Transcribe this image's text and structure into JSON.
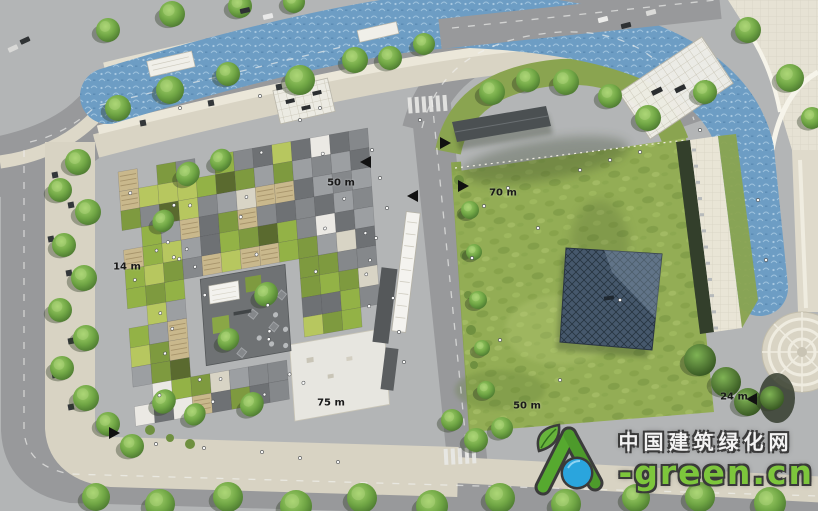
{
  "meta": {
    "title": "Landscape master plan rendering - checkerboard plaza and lawn pavilion site",
    "view": "aerial site plan"
  },
  "labels": {
    "plaza_top_width": "50 m",
    "plaza_module": "14 m",
    "plaza_length": "75 m",
    "lawn_top_width": "70 m",
    "lawn_bottom_width": "50 m",
    "lawn_side_depth": "24 m"
  },
  "icons": {
    "section_marker_left": "◀",
    "section_marker_right": "▶"
  },
  "watermark": {
    "site_name": "中国建筑绿化网",
    "site_domain": "-green.cn",
    "logo_name": "a-leaf-globe-logo",
    "brand_green": "#7dc63c",
    "brand_blue": "#2aa5dd"
  },
  "palette": {
    "road_base": "#b3b5b6",
    "road": "#98999b",
    "sidewalk": "#d9d4c4",
    "paving_white": "#ece8da",
    "water": "#6d9dc4",
    "water_texture": "#a7c9e2",
    "lawn": "#93ad55",
    "lawn_shadow": "#44582c",
    "verge_green": "#8aa450",
    "gridshell": "#46586c",
    "gridshell_line": "#263440",
    "plaza_dark": "#6f7274",
    "tree_dark": "#35571f",
    "tiles": {
      "gray": "#9c9fa2",
      "gray_mid": "#85888b",
      "gray_dark": "#6e7174",
      "white": "#ebe9e4",
      "beige": "#d8d4c5",
      "olive": "#7e9a3f",
      "green": "#93b246",
      "green_light": "#b7c75f",
      "wood": "#c9b88c",
      "green_dark": "#5a6a2f",
      "slate": "#aeb6ba"
    }
  }
}
